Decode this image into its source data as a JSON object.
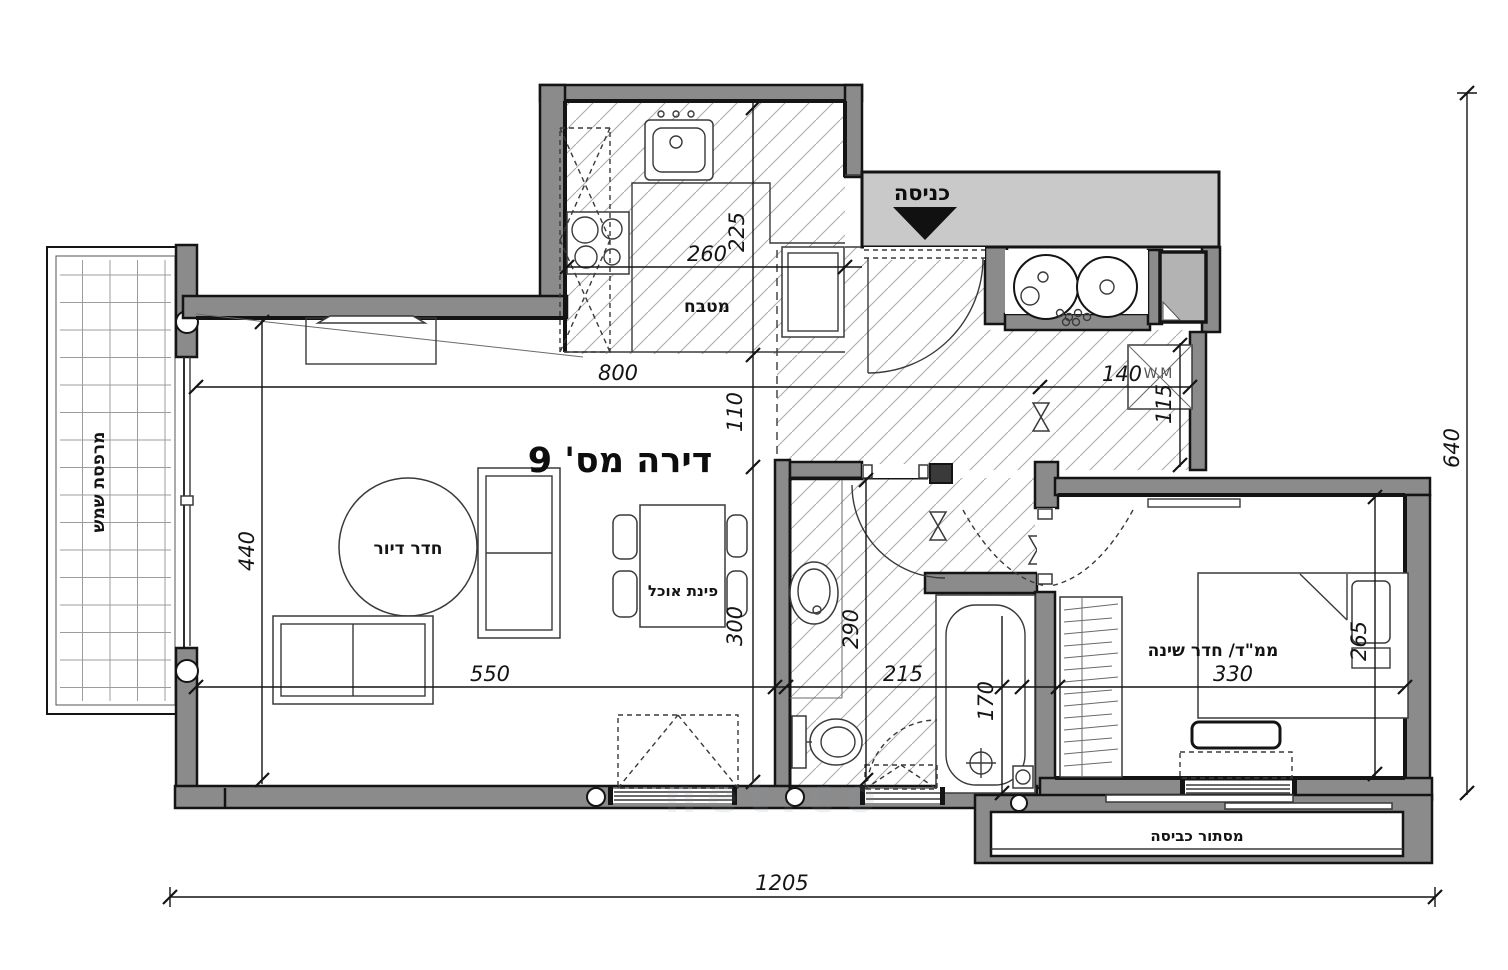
{
  "plan": {
    "title": "דירה מס' 9",
    "rooms": {
      "balcony": "מרפסת שמש",
      "living": "חדר דיור",
      "dining": "פינת אוכל",
      "kitchen": "מטבח",
      "entrance": "כניסה",
      "bedroom": "ממ\"ד/ חדר שינה",
      "laundry": "מסתור כביסה",
      "washing_machine": "W.M"
    },
    "dims": {
      "total_width": "1205",
      "total_height": "640",
      "living_width": "800",
      "living_depth": "440",
      "sofa_wall": "550",
      "kitchen_width": "260",
      "kitchen_depth": "225",
      "hall_strip": "110",
      "dining_depth": "300",
      "bath_depth": "290",
      "bath_width": "215",
      "tub_length": "170",
      "utility_width": "140",
      "utility_depth": "115",
      "bedroom_width": "330",
      "bedroom_depth": "265"
    },
    "watermark": "net.co",
    "colors": {
      "wall": "#8b8b8b",
      "entry_band": "#c9c9c9",
      "shaft": "#b3b3b3",
      "line": "#141414",
      "hatch": "#ababab"
    }
  }
}
